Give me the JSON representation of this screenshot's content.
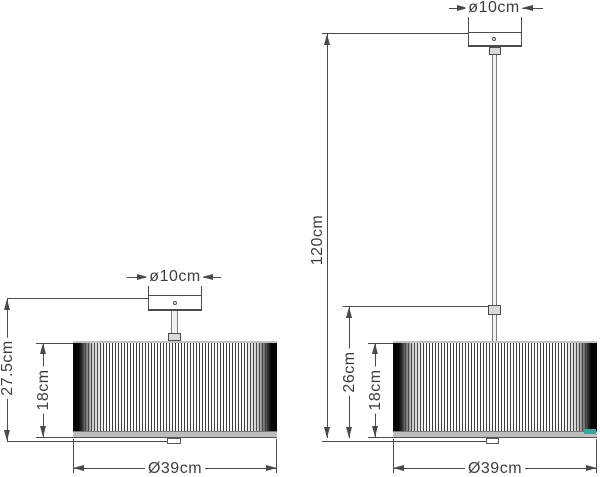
{
  "labels": {
    "left": {
      "canopy_diameter": "ø10cm",
      "total_height": "27.5cm",
      "shade_height": "18cm",
      "shade_diameter": "Ø39cm"
    },
    "right": {
      "canopy_diameter": "ø10cm",
      "suspension_height": "120cm",
      "body_height": "26cm",
      "shade_height": "18cm",
      "shade_diameter": "Ø39cm"
    }
  },
  "colors": {
    "line": "#4a4a4a",
    "text": "#3e3e3e",
    "pleat": "#3c3c3c",
    "shade_edge": "#060606",
    "rim": "#bdbdbd",
    "highlight": "#3ba79c"
  }
}
